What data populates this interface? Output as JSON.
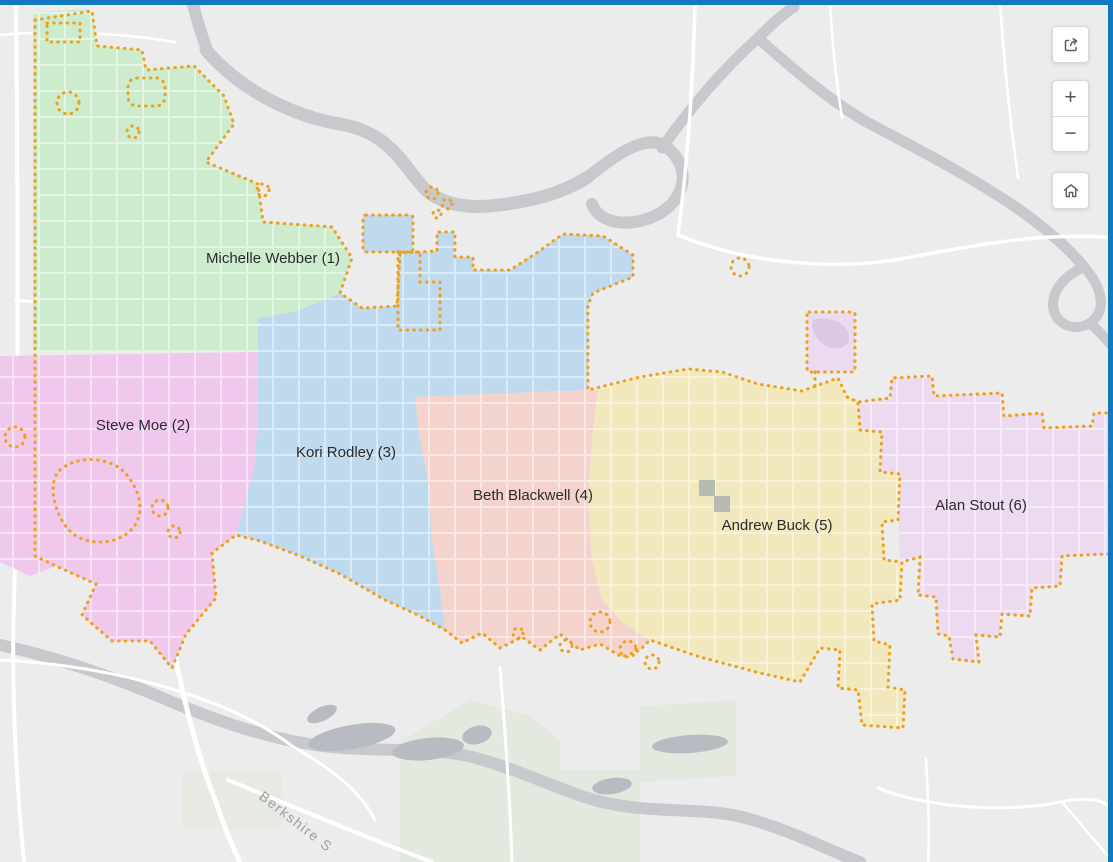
{
  "chrome": {
    "frame_color": "#1478be"
  },
  "map": {
    "background": "#ececec",
    "road_color": "#ffffff",
    "river_color": "#c7c9cd",
    "pond_color": "#b9bbc2",
    "park_color": "#e4e9df",
    "building_color": "#b7bbb2",
    "boundary_color": "#eba21e",
    "label_color": "#2b2b2b",
    "street_label_color": "#9aa0a3",
    "street_label": "Berkshire S"
  },
  "territories": [
    {
      "number": 1,
      "name": "Michelle Webber",
      "label": "Michelle Webber (1)",
      "color": "#cdecce"
    },
    {
      "number": 2,
      "name": "Steve Moe",
      "label": "Steve Moe (2)",
      "color": "#f0c8ec"
    },
    {
      "number": 3,
      "name": "Kori Rodley",
      "label": "Kori Rodley (3)",
      "color": "#bfd9ee"
    },
    {
      "number": 4,
      "name": "Beth Blackwell",
      "label": "Beth Blackwell (4)",
      "color": "#f5d3cd"
    },
    {
      "number": 5,
      "name": "Andrew Buck",
      "label": "Andrew Buck (5)",
      "color": "#f2e8bd"
    },
    {
      "number": 6,
      "name": "Alan Stout",
      "label": "Alan Stout (6)",
      "color": "#ecdaf0"
    }
  ],
  "controls": {
    "zoom_in": "+",
    "zoom_out": "−"
  }
}
